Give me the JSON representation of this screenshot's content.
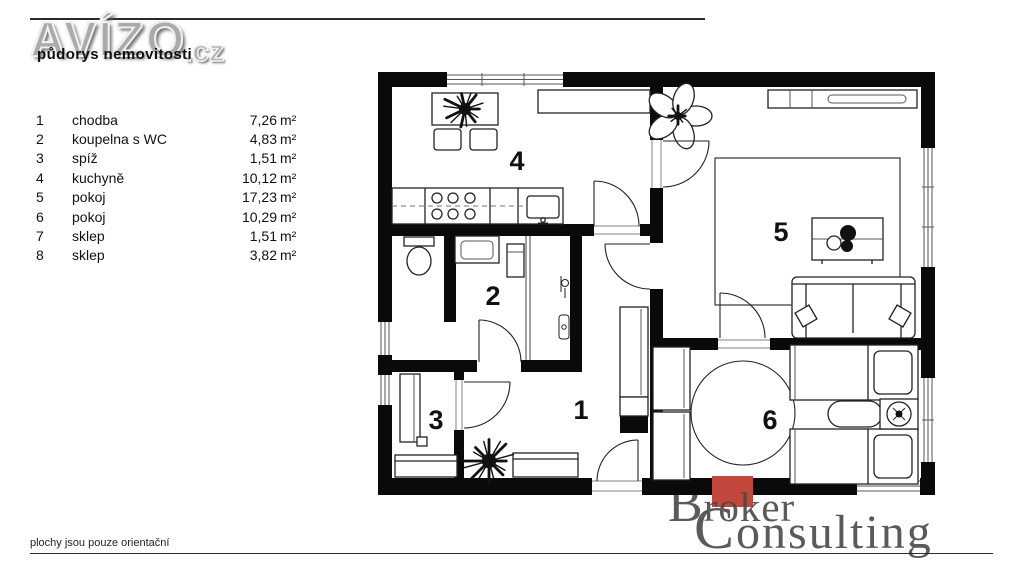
{
  "header": {
    "brand": "AVÍZO",
    "brand_tld": ".cz",
    "subtitle": "půdorys nemovitosti"
  },
  "legend": {
    "rows": [
      {
        "num": "1",
        "name": "chodba",
        "area": "7,26",
        "unit": "m²"
      },
      {
        "num": "2",
        "name": "koupelna s WC",
        "area": "4,83",
        "unit": "m²"
      },
      {
        "num": "3",
        "name": "spíž",
        "area": "1,51",
        "unit": "m²"
      },
      {
        "num": "4",
        "name": "kuchyně",
        "area": "10,12",
        "unit": "m²"
      },
      {
        "num": "5",
        "name": "pokoj",
        "area": "17,23",
        "unit": "m²"
      },
      {
        "num": "6",
        "name": "pokoj",
        "area": "10,29",
        "unit": "m²"
      },
      {
        "num": "7",
        "name": "sklep",
        "area": "1,51",
        "unit": "m²"
      },
      {
        "num": "8",
        "name": "sklep",
        "area": "3,82",
        "unit": "m²"
      }
    ]
  },
  "plan": {
    "labels": {
      "r1": "1",
      "r2": "2",
      "r3": "3",
      "r4": "4",
      "r5": "5",
      "r6": "6"
    }
  },
  "footer": {
    "disclaimer": "plochy jsou pouze orientační"
  },
  "watermark": {
    "b": "B",
    "roker": "roker",
    "c": "C",
    "onsulting": "onsulting",
    "accent_color": "#c2473c"
  },
  "colors": {
    "wall": "#0a0a0a",
    "line": "#222222",
    "background": "#ffffff"
  }
}
